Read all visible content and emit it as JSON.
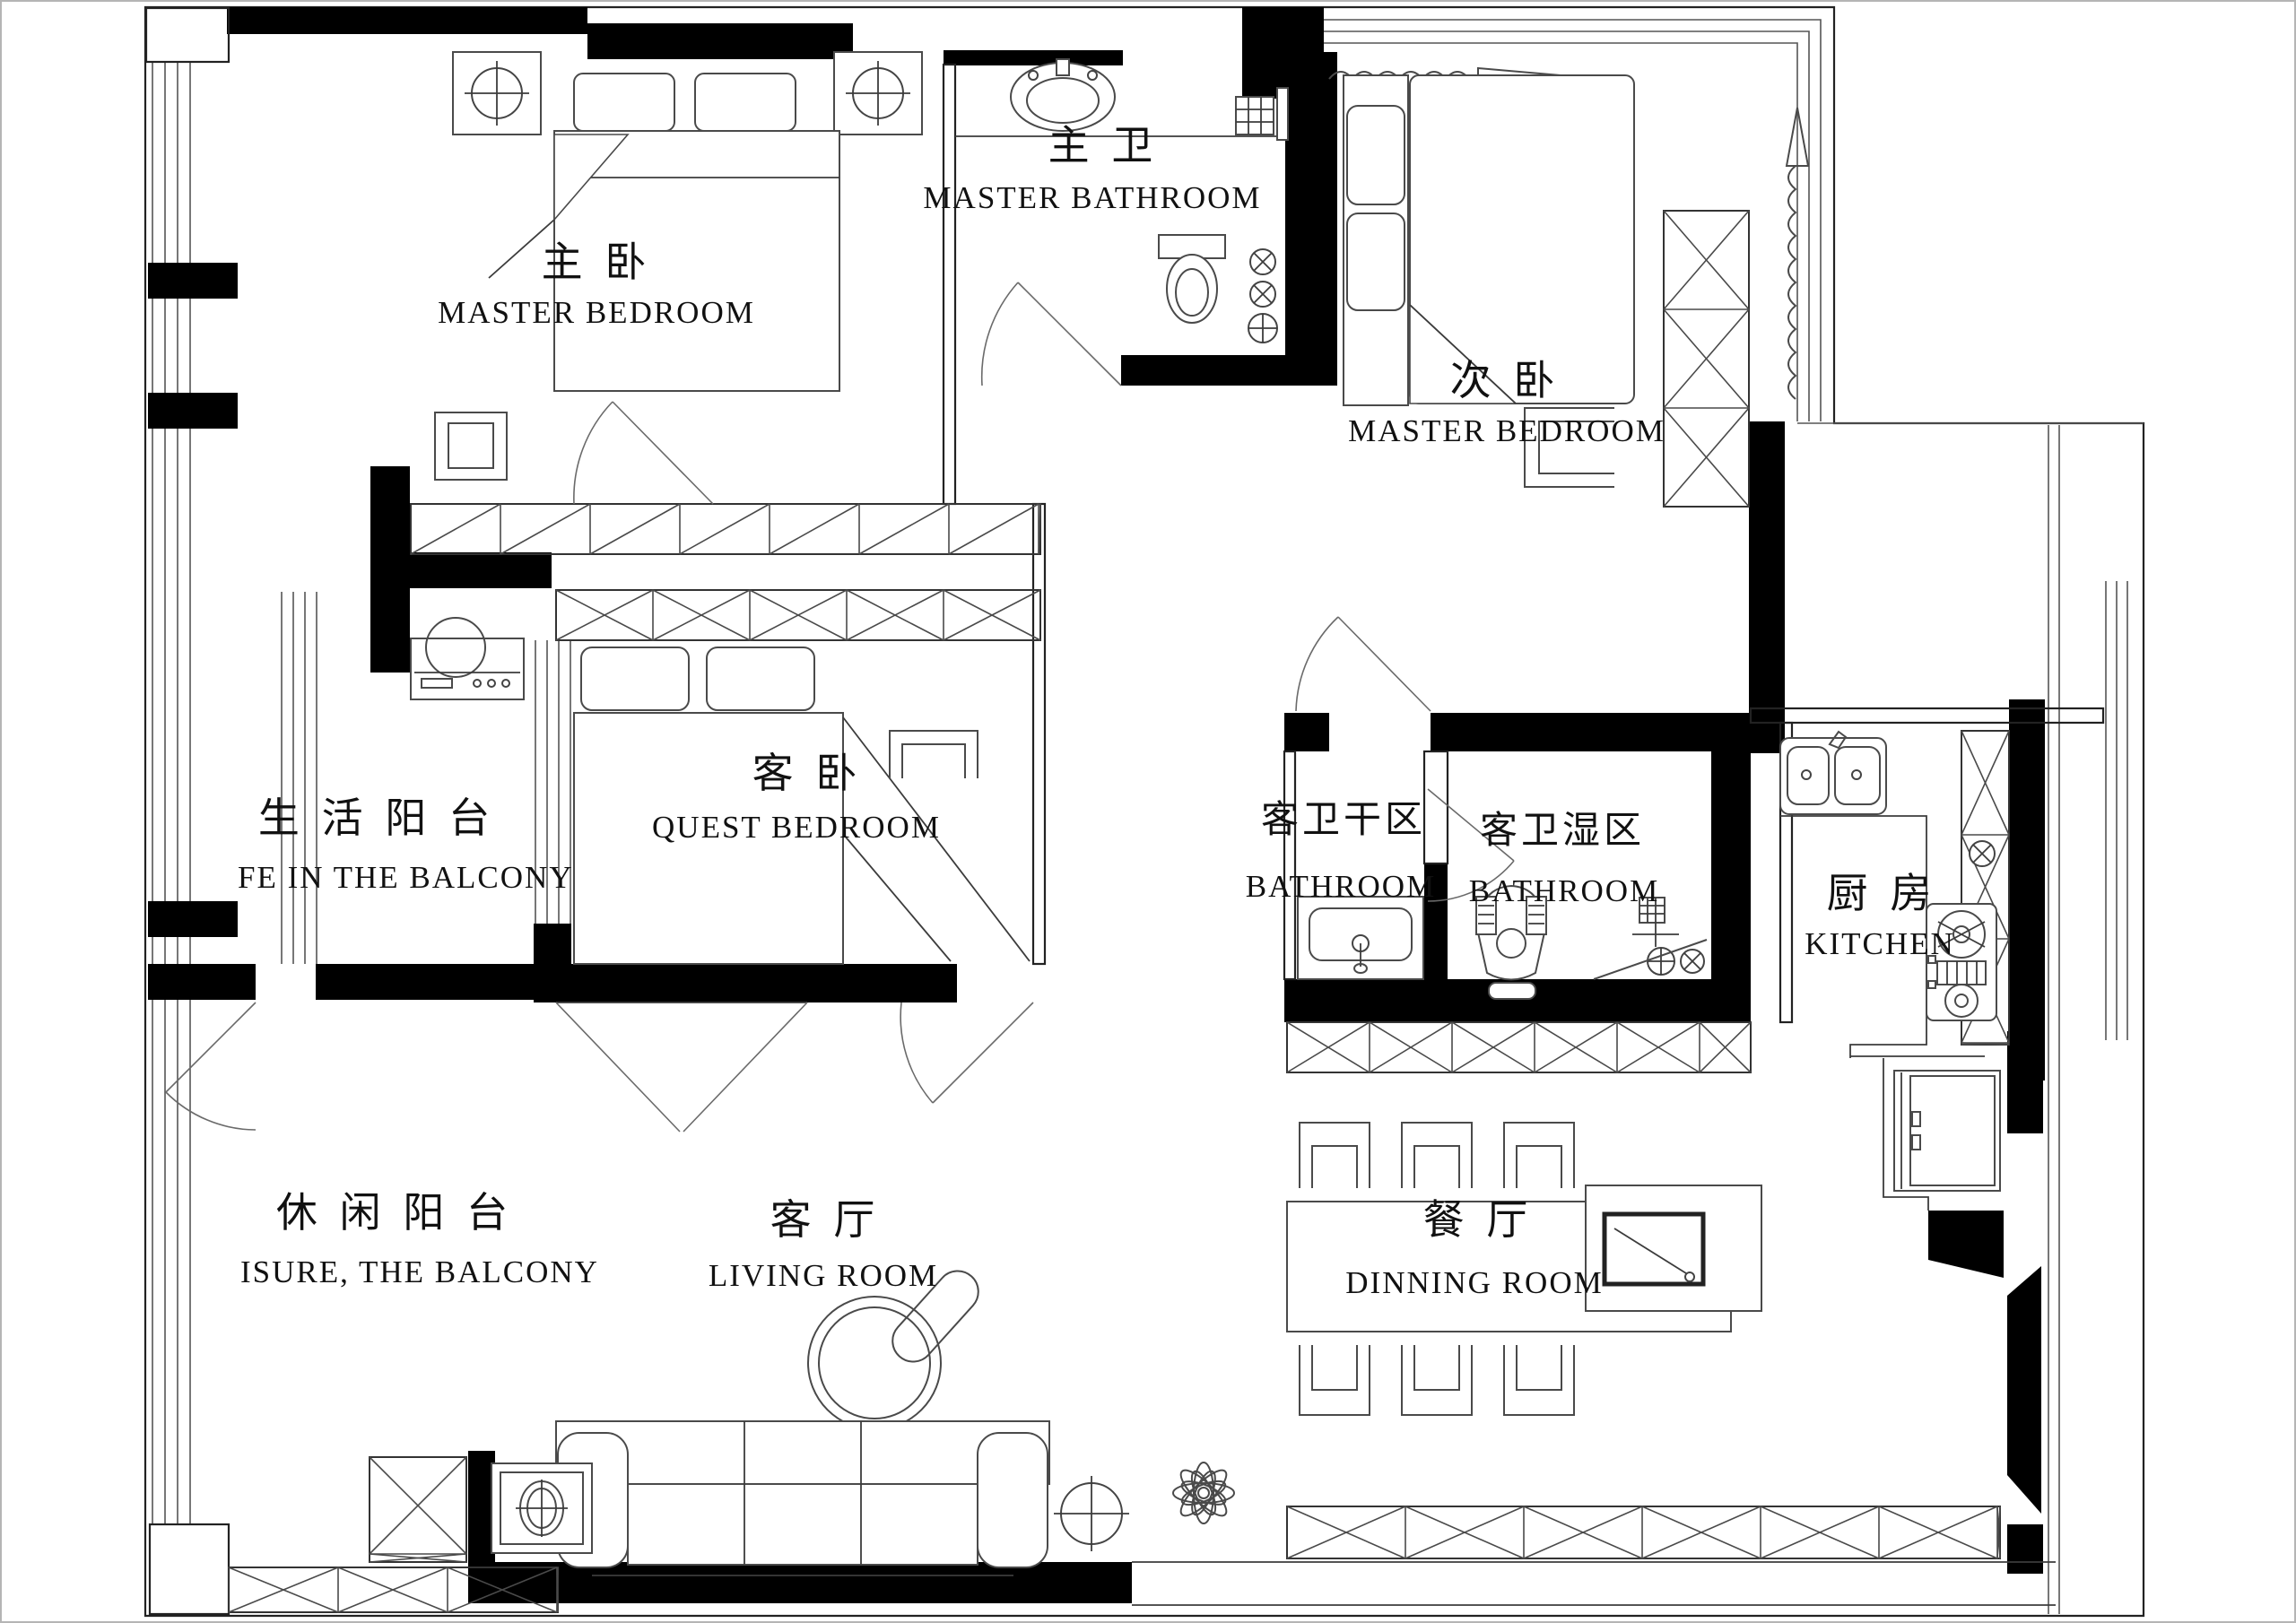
{
  "drawing": {
    "type": "apartment floor plan",
    "colors": {
      "walls": "#000000",
      "lines": "#3c3c3c",
      "background": "#ffffff"
    }
  },
  "rooms": {
    "master_bedroom": {
      "zh": "主 卧",
      "en": "MASTER BEDROOM"
    },
    "master_bathroom": {
      "zh": "主 卫",
      "en": "MASTER BATHROOM"
    },
    "second_bedroom": {
      "zh": "次 卧",
      "en": "MASTER BEDROOM"
    },
    "guest_bedroom": {
      "zh": "客 卧",
      "en": "QUEST BEDROOM"
    },
    "life_balcony": {
      "zh": "生 活 阳 台",
      "en": "FE IN THE BALCONY"
    },
    "guest_bath_dry": {
      "zh": "客卫干区",
      "en": "BATHROOM"
    },
    "guest_bath_wet": {
      "zh": "客卫湿区",
      "en": "BATHROOM"
    },
    "kitchen": {
      "zh": "厨 房",
      "en": "KITCHEN"
    },
    "leisure_balcony": {
      "zh": "休 闲 阳 台",
      "en": "ISURE, THE BALCONY"
    },
    "living_room": {
      "zh": "客 厅",
      "en": "LIVING ROOM"
    },
    "dining_room": {
      "zh": "餐 厅",
      "en": "DINNING ROOM"
    }
  }
}
